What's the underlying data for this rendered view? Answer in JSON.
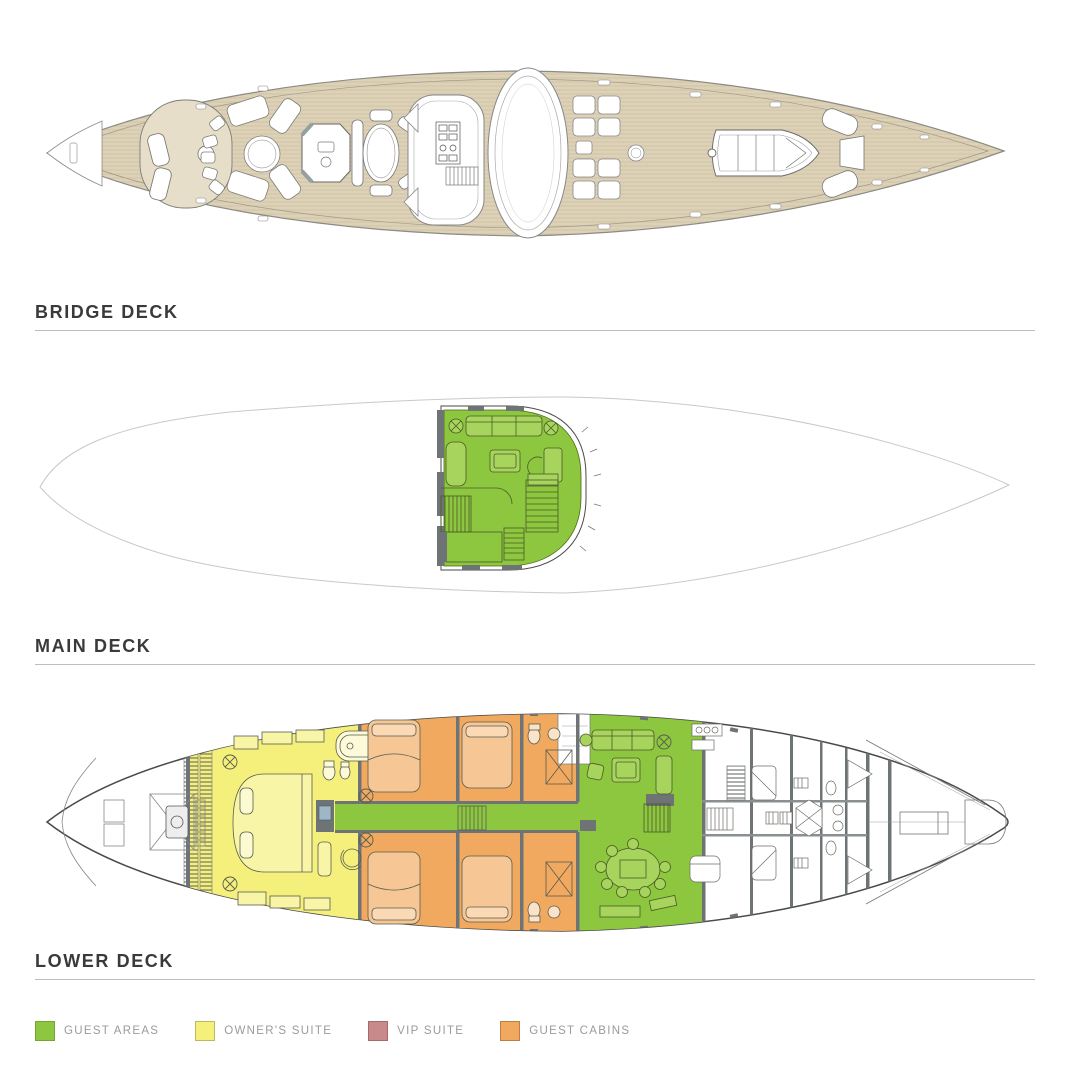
{
  "decks": [
    {
      "label": "BRIDGE DECK"
    },
    {
      "label": "MAIN DECK"
    },
    {
      "label": "LOWER DECK"
    }
  ],
  "legend": {
    "items": [
      {
        "label": "GUEST AREAS",
        "color": "#8DC63F",
        "border": "#76A42F"
      },
      {
        "label": "OWNER'S SUITE",
        "color": "#F4F07B",
        "border": "#BEB95C"
      },
      {
        "label": "VIP SUITE",
        "color": "#C98A8C",
        "border": "#A26C6E"
      },
      {
        "label": "GUEST CABINS",
        "color": "#F0A95F",
        "border": "#BC7F41"
      }
    ]
  },
  "colors": {
    "deck_teak": "#DDD1B8",
    "plank_line": "#CBBD9E",
    "hull_outline": "#8B8B84",
    "faint_hull": "#C9C9C9",
    "wall_gray": "#6E7376",
    "title_text": "#3A3A3A",
    "rule_gray": "#BDBDBD",
    "legend_text": "#9B9B9B"
  }
}
